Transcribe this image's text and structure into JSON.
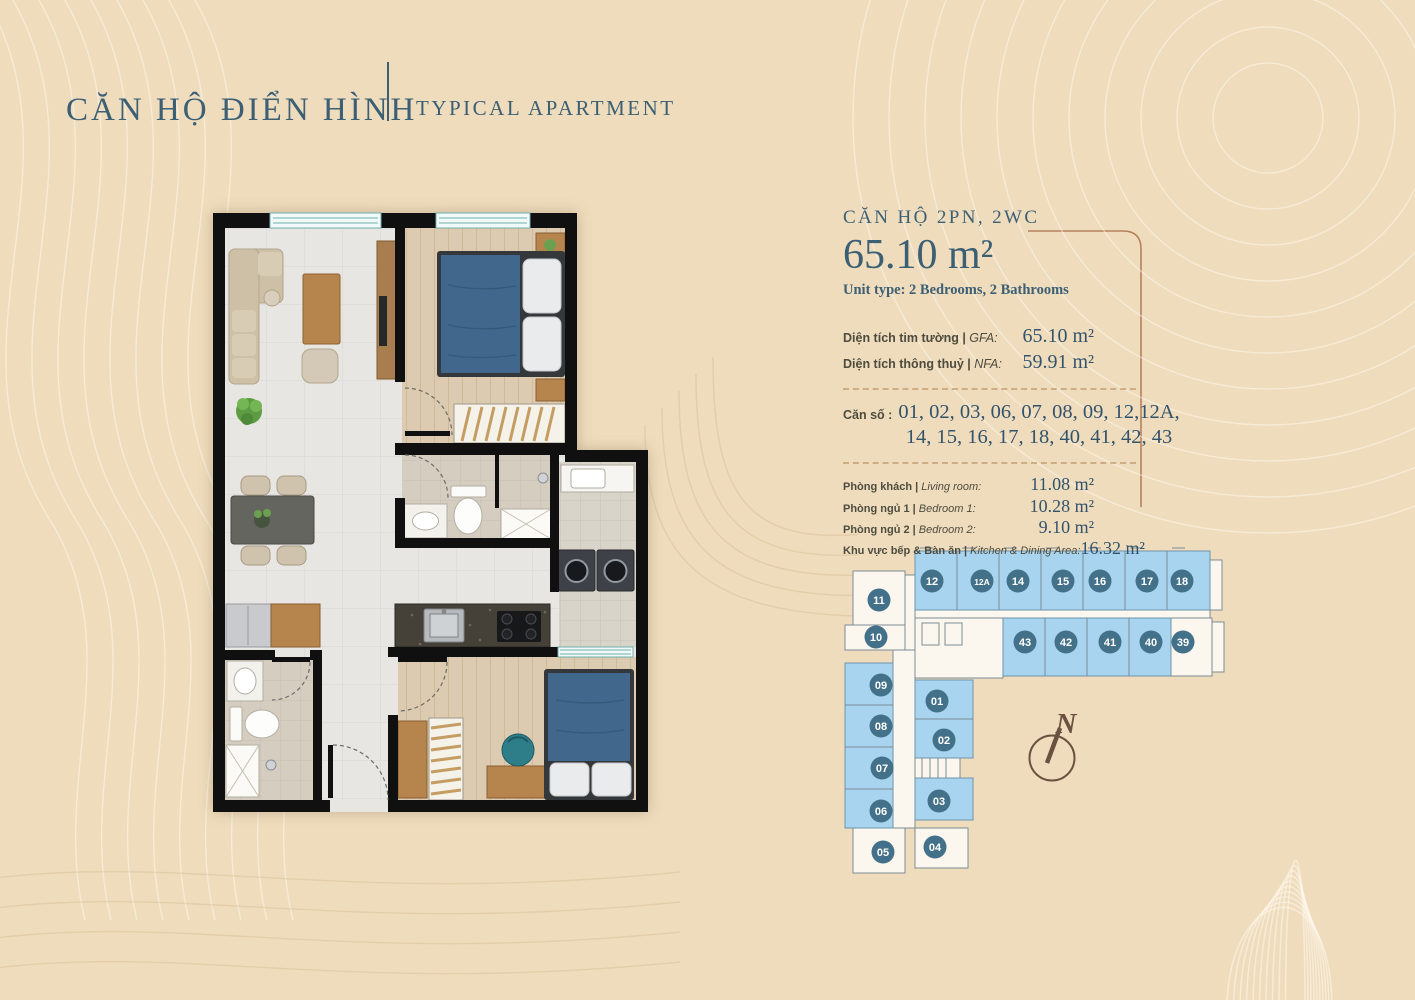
{
  "header": {
    "title_vi": "CĂN HỘ ĐIỂN HÌNH",
    "title_en": "TYPICAL APARTMENT"
  },
  "unit_info": {
    "heading": "CĂN HỘ 2PN, 2WC",
    "area": "65.10 m²",
    "unit_type": "Unit type: 2 Bedrooms, 2 Bathrooms",
    "metrics": [
      {
        "label_vi": "Diện tích tim tường | ",
        "label_en": "GFA:",
        "value": "65.10 m²"
      },
      {
        "label_vi": "Diện tích thông thuỷ | ",
        "label_en": "NFA:",
        "value": "59.91 m²"
      }
    ],
    "unit_numbers_label": "Căn số :",
    "unit_numbers_line1": "01, 02, 03, 06, 07, 08, 09, 12,12A,",
    "unit_numbers_line2": "14, 15, 16, 17, 18, 40, 41, 42, 43",
    "rooms": [
      {
        "label_vi": "Phòng khách | ",
        "label_en": "Living room:",
        "value": "11.08 m²"
      },
      {
        "label_vi": "Phòng ngủ 1 | ",
        "label_en": "Bedroom 1:",
        "value": "10.28 m²"
      },
      {
        "label_vi": "Phòng ngủ 2 | ",
        "label_en": "Bedroom 2:",
        "value": "9.10 m²"
      },
      {
        "label_vi": "Khu vực bếp & Bàn ăn | ",
        "label_en": "Kitchen & Dining Area:",
        "value": "16.32 m²"
      }
    ]
  },
  "key_plan": {
    "north_label": "N",
    "units": [
      {
        "n": "12",
        "x": 932,
        "y": 581,
        "highlighted": true
      },
      {
        "n": "12A",
        "x": 982,
        "y": 581,
        "highlighted": true
      },
      {
        "n": "14",
        "x": 1018,
        "y": 581,
        "highlighted": true
      },
      {
        "n": "15",
        "x": 1063,
        "y": 581,
        "highlighted": true
      },
      {
        "n": "16",
        "x": 1100,
        "y": 581,
        "highlighted": true
      },
      {
        "n": "17",
        "x": 1147,
        "y": 581,
        "highlighted": true
      },
      {
        "n": "18",
        "x": 1182,
        "y": 581,
        "highlighted": true
      },
      {
        "n": "43",
        "x": 1025,
        "y": 642,
        "highlighted": true
      },
      {
        "n": "42",
        "x": 1066,
        "y": 642,
        "highlighted": true
      },
      {
        "n": "41",
        "x": 1110,
        "y": 642,
        "highlighted": true
      },
      {
        "n": "40",
        "x": 1151,
        "y": 642,
        "highlighted": true
      },
      {
        "n": "39",
        "x": 1183,
        "y": 642,
        "highlighted": false
      },
      {
        "n": "11",
        "x": 879,
        "y": 600,
        "highlighted": false
      },
      {
        "n": "10",
        "x": 876,
        "y": 637,
        "highlighted": false
      },
      {
        "n": "09",
        "x": 881,
        "y": 685,
        "highlighted": true
      },
      {
        "n": "08",
        "x": 881,
        "y": 726,
        "highlighted": true
      },
      {
        "n": "07",
        "x": 882,
        "y": 768,
        "highlighted": true
      },
      {
        "n": "06",
        "x": 881,
        "y": 811,
        "highlighted": true
      },
      {
        "n": "05",
        "x": 883,
        "y": 852,
        "highlighted": false
      },
      {
        "n": "01",
        "x": 937,
        "y": 701,
        "highlighted": true
      },
      {
        "n": "02",
        "x": 944,
        "y": 740,
        "highlighted": true
      },
      {
        "n": "03",
        "x": 939,
        "y": 801,
        "highlighted": true
      },
      {
        "n": "04",
        "x": 935,
        "y": 847,
        "highlighted": false
      }
    ]
  },
  "colors": {
    "background": "#eedcbd",
    "title_ink": "#3c5f74",
    "value_ink": "#33536b",
    "label_ink": "#4e4c3e",
    "accent_line": "#b5825c",
    "unit_blue": "#a9d4ef",
    "unit_circle": "#44718a",
    "dash": "#c09a6e",
    "wall": "#101010",
    "window_teal": "#6fb0aa",
    "bed_blue": "#41688c"
  }
}
